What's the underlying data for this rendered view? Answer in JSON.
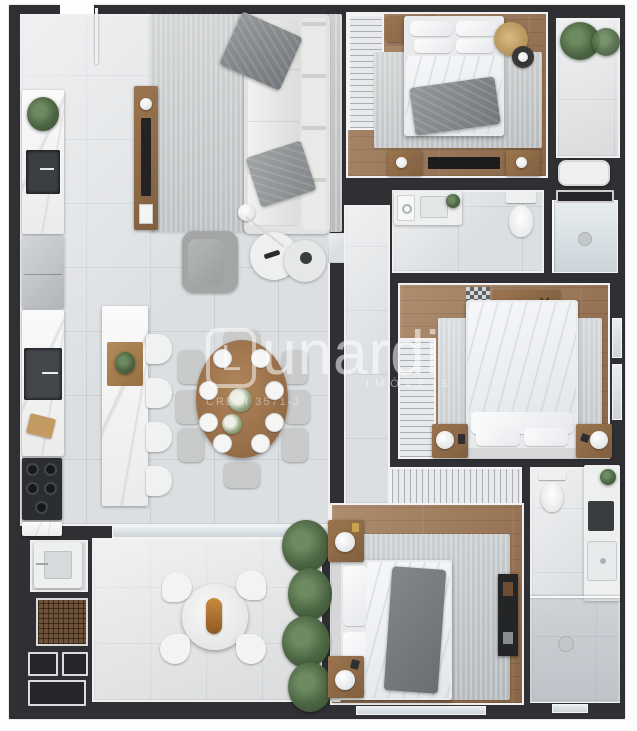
{
  "meta": {
    "kind": "3d-rendered-apartment-floor-plan",
    "canvas": {
      "width": 637,
      "height": 731
    }
  },
  "watermark": {
    "brand_initial": "L",
    "brand_rest": "unardi",
    "subtitle": "IMÓVEIS",
    "creci": "CRECI 3571-J"
  },
  "palette": {
    "wall": "#303034",
    "tile": "#dcdfe2",
    "tile2": "#e2e4e5",
    "wood": "#9c7450",
    "rug": "#c5c8ca",
    "marble": "#f2f3f2",
    "whitefurn": "#eef0f0",
    "chair": "#c9cbca",
    "darkbox": "#26262a",
    "grill": "#6f5238",
    "sofa": "#e2e3e1",
    "plantgreen": "#4c6543",
    "tablewood": "#a3794f"
  },
  "rooms": [
    {
      "name": "living-dining-kitchen",
      "furniture": [
        "l-shaped-sofa",
        "area-rug",
        "armchair",
        "coffee-tables",
        "floor-lamp",
        "tv-panel",
        "kitchen-counter",
        "sink",
        "refrigerator",
        "cooktop",
        "kitchen-island",
        "bar-stools-4",
        "oval-dining-table",
        "dining-chairs-8",
        "dinner-plates-8",
        "flower-centerpiece"
      ]
    },
    {
      "name": "terrace",
      "furniture": [
        "round-table",
        "chairs-4",
        "serving-tray",
        "potted-plants",
        "barbecue-grill",
        "laundry-tub",
        "utility-boxes"
      ]
    },
    {
      "name": "bedroom-1",
      "furniture": [
        "double-bed",
        "wardrobe",
        "dresser",
        "hat-side-table",
        "media-console",
        "area-rug"
      ]
    },
    {
      "name": "balcony-1",
      "furniture": [
        "plants-2",
        "bench-tub"
      ]
    },
    {
      "name": "bathroom-1",
      "furniture": [
        "vanity-sink",
        "washer",
        "toilet",
        "shower"
      ]
    },
    {
      "name": "bedroom-2",
      "furniture": [
        "double-bed",
        "wardrobe",
        "sideboard",
        "door-mat",
        "nightstands-2",
        "table-lamps",
        "window"
      ]
    },
    {
      "name": "bedroom-3",
      "furniture": [
        "double-bed",
        "wardrobe-row",
        "nightstands-2",
        "table-lamps",
        "tv-console",
        "area-rug",
        "window"
      ]
    },
    {
      "name": "bathroom-3",
      "furniture": [
        "toilet",
        "vanity-sink",
        "shower",
        "drain",
        "window"
      ]
    }
  ]
}
